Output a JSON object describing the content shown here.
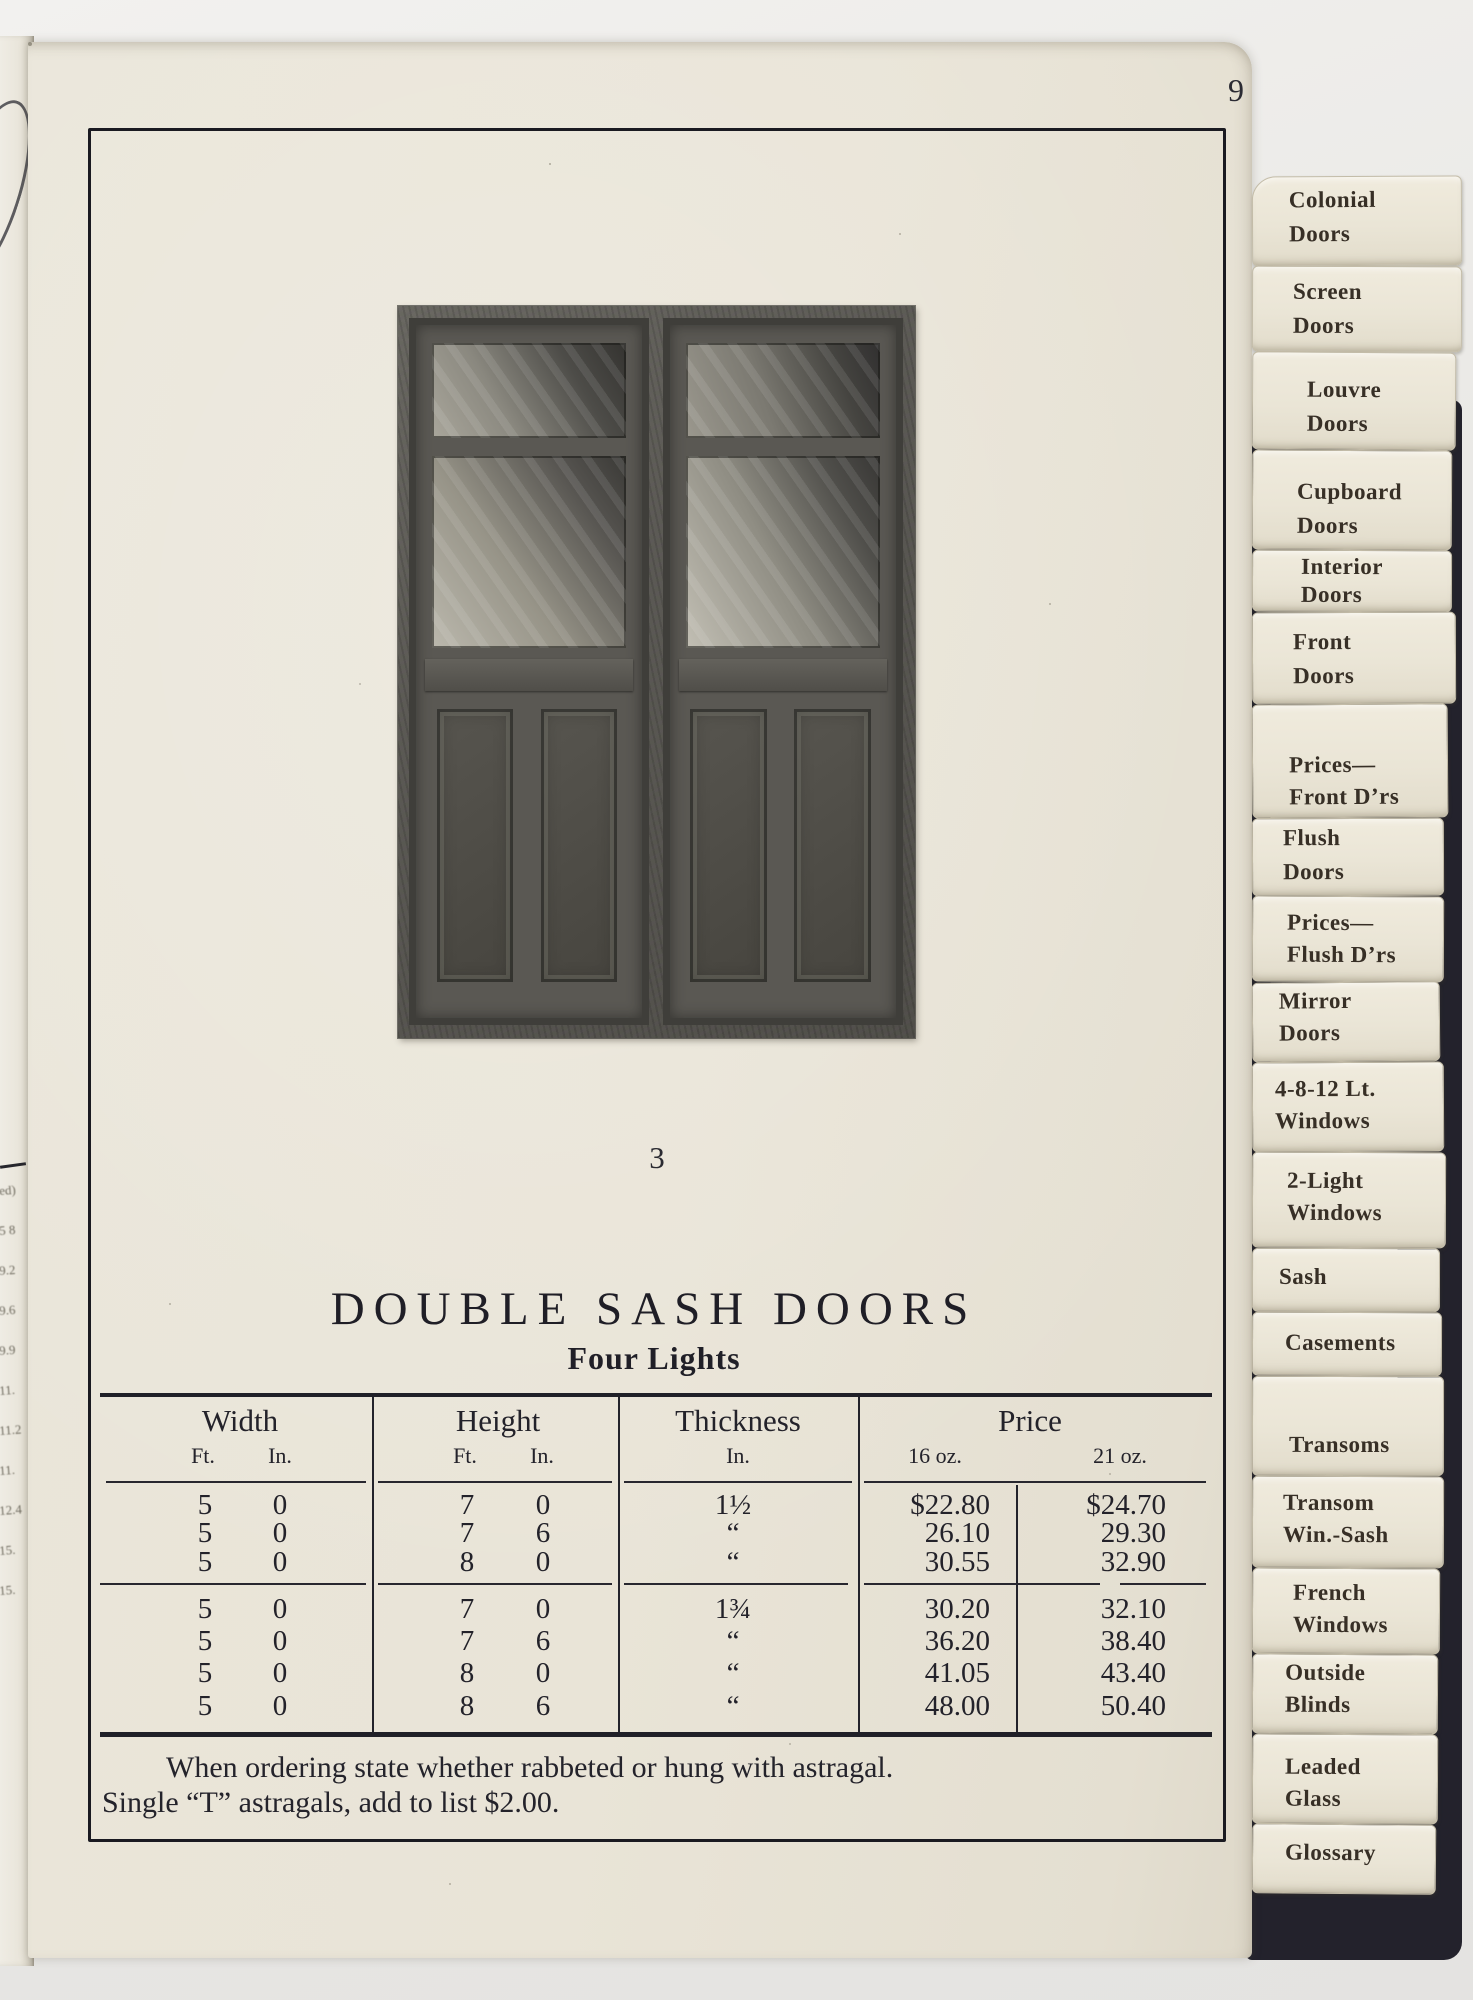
{
  "page_number": "9",
  "figure_caption": "3",
  "title": "DOUBLE SASH DOORS",
  "subtitle": "Four Lights",
  "table": {
    "col_width": "Width",
    "col_height": "Height",
    "col_thickness": "Thickness",
    "col_price": "Price",
    "sub_width_ft": "Ft.",
    "sub_width_in": "In.",
    "sub_height_ft": "Ft.",
    "sub_height_in": "In.",
    "sub_thickness_in": "In.",
    "sub_16oz": "16 oz.",
    "sub_21oz": "21 oz.",
    "rows": [
      {
        "wf": "5",
        "wi": "0",
        "hf": "7",
        "hi": "0",
        "t": "1½",
        "p16": "$22.80",
        "p21": "$24.70"
      },
      {
        "wf": "5",
        "wi": "0",
        "hf": "7",
        "hi": "6",
        "t": "“",
        "p16": "26.10",
        "p21": "29.30"
      },
      {
        "wf": "5",
        "wi": "0",
        "hf": "8",
        "hi": "0",
        "t": "“",
        "p16": "30.55",
        "p21": "32.90"
      },
      {
        "wf": "5",
        "wi": "0",
        "hf": "7",
        "hi": "0",
        "t": "1¾",
        "p16": "30.20",
        "p21": "32.10"
      },
      {
        "wf": "5",
        "wi": "0",
        "hf": "7",
        "hi": "6",
        "t": "“",
        "p16": "36.20",
        "p21": "38.40"
      },
      {
        "wf": "5",
        "wi": "0",
        "hf": "8",
        "hi": "0",
        "t": "“",
        "p16": "41.05",
        "p21": "43.40"
      },
      {
        "wf": "5",
        "wi": "0",
        "hf": "8",
        "hi": "6",
        "t": "“",
        "p16": "48.00",
        "p21": "50.40"
      }
    ]
  },
  "note_line1": "When ordering state whether rabbeted or hung with astragal.",
  "note_line2": "Single “T” astragals, add to list $2.00.",
  "tabs": [
    {
      "lines": [
        "Colonial",
        "Doors"
      ]
    },
    {
      "lines": [
        "Screen",
        "Doors"
      ]
    },
    {
      "lines": [
        "Louvre",
        "Doors"
      ]
    },
    {
      "lines": [
        "Cupboard",
        "Doors"
      ]
    },
    {
      "lines": [
        "Interior",
        "Doors"
      ]
    },
    {
      "lines": [
        "Front",
        "Doors"
      ]
    },
    {
      "lines": [
        "Prices—",
        "Front D’rs"
      ]
    },
    {
      "lines": [
        "Flush",
        "Doors"
      ]
    },
    {
      "lines": [
        "Prices—",
        "Flush D’rs"
      ]
    },
    {
      "lines": [
        "Mirror",
        "Doors"
      ]
    },
    {
      "lines": [
        "4-8-12 Lt.",
        "Windows"
      ]
    },
    {
      "lines": [
        "2-Light",
        "Windows"
      ]
    },
    {
      "lines": [
        "Sash"
      ]
    },
    {
      "lines": [
        "Casements"
      ]
    },
    {
      "lines": [
        "Transoms"
      ]
    },
    {
      "lines": [
        "Transom",
        "Win.-Sash"
      ]
    },
    {
      "lines": [
        "French",
        "Windows"
      ]
    },
    {
      "lines": [
        "Outside",
        "Blinds"
      ]
    },
    {
      "lines": [
        "Leaded",
        "Glass"
      ]
    },
    {
      "lines": [
        "Glossary"
      ]
    }
  ],
  "prev_page_fragments": [
    "ed)",
    "5 8",
    "9.2",
    "9.6",
    "9.9",
    "11.",
    "11.2",
    "11.",
    "12.4",
    "15.",
    "15."
  ]
}
